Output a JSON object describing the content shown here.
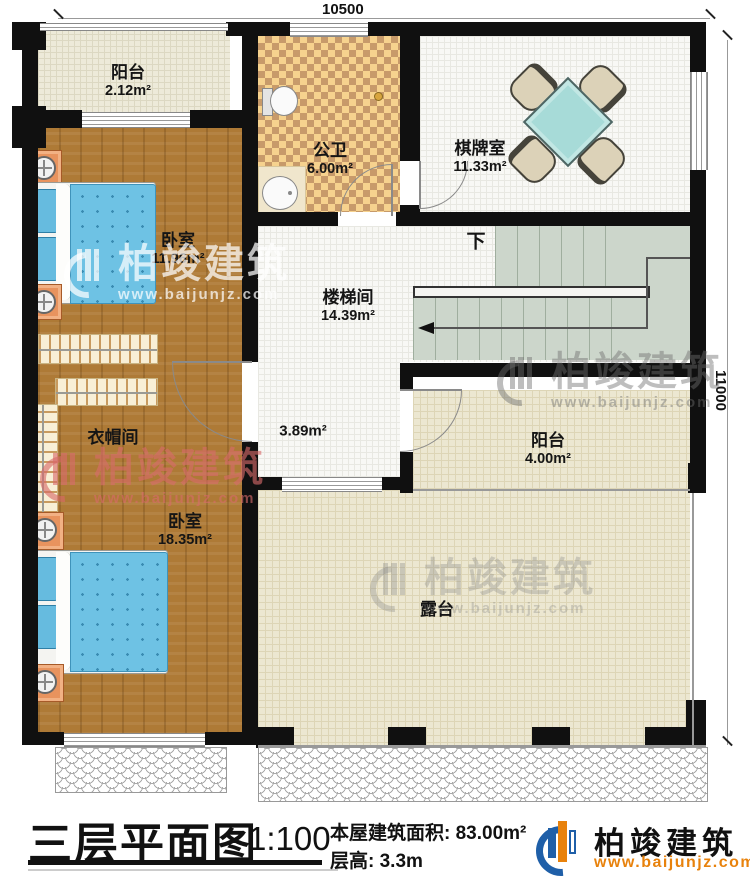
{
  "dimensions": {
    "width": "10500",
    "height": "11000"
  },
  "rooms": {
    "balcony_top": {
      "name": "阳台",
      "area": "2.12m²"
    },
    "bathroom": {
      "name": "公卫",
      "area": "6.00m²"
    },
    "game_room": {
      "name": "棋牌室",
      "area": "11.33m²"
    },
    "bedroom_1": {
      "name": "卧室",
      "area": "11.96m²"
    },
    "stairwell": {
      "name": "楼梯间",
      "area": "14.39m²"
    },
    "hall_area": {
      "area": "3.89m²"
    },
    "cloakroom": {
      "name": "衣帽间"
    },
    "bedroom_2": {
      "name": "卧室",
      "area": "18.35m²"
    },
    "balcony_right": {
      "name": "阳台",
      "area": "4.00m²"
    },
    "terrace": {
      "name": "露台"
    }
  },
  "stairs": {
    "direction_label": "下"
  },
  "watermark": {
    "brand": "柏竣建筑",
    "website": "www.baijunjz.com"
  },
  "footer": {
    "title": "三层平面图",
    "scale": "1:100",
    "building_area": "本屋建筑面积: 83.00m²",
    "floor_height": "层高: 3.3m",
    "brand": "柏竣建筑",
    "website": "www.baijunjz.com"
  },
  "colors": {
    "wall": "#101010",
    "wood_floor": "#ae7a36",
    "bathroom_tile": "#f6d28e",
    "bathroom_tile_dark": "#c79a6a",
    "stair_tread": "#ccd6cb",
    "terrace_floor": "#ece7d1",
    "bed_blue": "#6ec2e4",
    "table_teal": "#a7dbd8",
    "logo_blue": "#1f5fa8",
    "logo_orange": "#e8820c",
    "watermark_pink": "#d86a6a"
  }
}
